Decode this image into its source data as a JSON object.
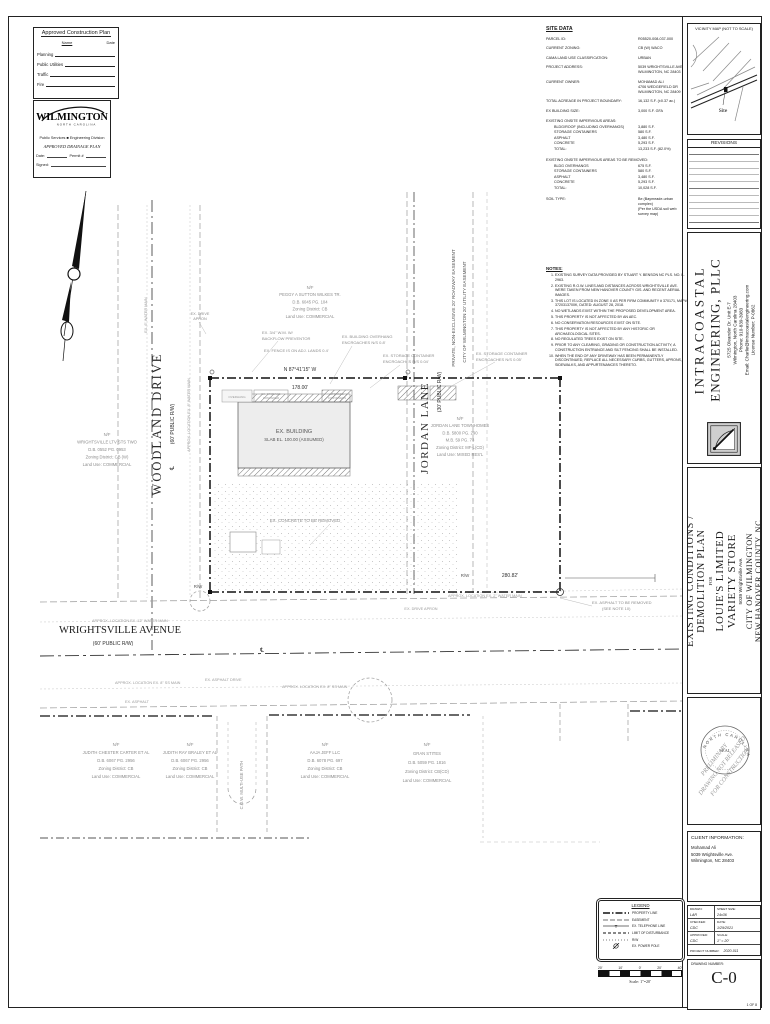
{
  "colors": {
    "ink": "#1a1a1a",
    "muted": "#8a8a8a",
    "paper": "#ffffff"
  },
  "approval_box": {
    "title": "Approved Construction Plan",
    "col_name": "Name",
    "col_date": "Date",
    "rows": [
      "Planning",
      "Public Utilities",
      "Traffic",
      "Fire"
    ]
  },
  "wilmington_box": {
    "city": "WILMINGTON",
    "state": "NORTH CAROLINA",
    "dept": "Public Services  ■  Engineering Division",
    "plan_type": "APPROVED DRAINAGE PLAN",
    "date_label": "Date:",
    "permit_label": "Permit #",
    "signed_label": "Signed:"
  },
  "site_data": {
    "title": "SITE DATA",
    "rows": [
      {
        "l": "PARCEL ID:",
        "v": [
          "R05520-008-037-000"
        ]
      },
      {
        "l": "CURRENT ZONING:",
        "v": [
          "CB (W) WACO"
        ]
      },
      {
        "l": "CAMA LAND USE CLASSIFICATION:",
        "v": [
          "URBAN"
        ]
      },
      {
        "l": "PROJECT ADDRESS:",
        "v": [
          "5039 WRIGHTSVILLE AVE",
          "WILMINGTON, NC 28403"
        ]
      },
      {
        "l": "CURRENT OWNER:",
        "v": [
          "MOHAMAD ALI",
          "4706 WEDGEFIELD DR",
          "WILMINGTON, NC 28409"
        ]
      },
      {
        "l": "TOTAL ACREAGE IN PROJECT BOUNDARY:",
        "v": [
          "16,132 S.F. (±0.37 ac.)"
        ]
      },
      {
        "l": "EX BUILDING SIZE:",
        "v": [
          "3,000 S.F. GFA"
        ]
      }
    ],
    "impervious_title": "EXISTING ONSITE IMPERVIOUS AREAS:",
    "impervious_rows": [
      {
        "l": "BLDG/ROOF (INCLUDING OVERHANGS)",
        "v": "3,880 S.F."
      },
      {
        "l": "STORAGE CONTAINERS",
        "v": "580 S.F."
      },
      {
        "l": "ASPHALT",
        "v": "3,480 S.F."
      },
      {
        "l": "CONCRETE",
        "v": "5,293 S.F."
      },
      {
        "l": "TOTAL:",
        "v": "13,233 S.F. (82.0%)"
      }
    ],
    "removed_title": "EXISTING ONSITE IMPERVIOUS AREAS TO BE REMOVED:",
    "removed_rows": [
      {
        "l": "BLDG OVERHANGS",
        "v": "675 S.F."
      },
      {
        "l": "STORAGE CONTAINERS",
        "v": "580 S.F."
      },
      {
        "l": "ASPHALT",
        "v": "3,480 S.F."
      },
      {
        "l": "CONCRETE",
        "v": "5,293 S.F."
      },
      {
        "l": "TOTAL:",
        "v": "10,028 S.F."
      }
    ],
    "soil_label": "SOIL TYPE:",
    "soil_v1": "Be (Baymeade-urban complex)",
    "soil_v2": "(Per the USDA soil web survey map)"
  },
  "notes": {
    "title": "NOTES:",
    "items": [
      "EXISTING SURVEY DATA PROVIDED BY STUART Y. BENSON NC PLS. NO. L-2963.",
      "EXISTING R.O.W. LINES AND DISTANCES ACROSS WRIGHTSVILLE AVE. WERE TAKEN FROM NEW HANOVER COUNTY GIS. AND RECENT AERIAL IMAGES.",
      "THIS LOT IS LOCATED IN ZONE X AS PER FIRM COMMUNITY # 370171, MAP# 3720313700K, DATED: AUGUST 28, 2018.",
      "NO WETLANDS EXIST WITHIN THE PROPOSED DEVELOPMENT AREA.",
      "THIS PROPERTY IS NOT AFFECTED BY AN AEC.",
      "NO CONSERVATION RESOURCES EXIST ON SITE.",
      "THIS PROPERTY IS NOT AFFECTED BY ANY HISTORIC OR ARCHAEOLOGICAL SITES.",
      "NO REGULATED TREES EXIST ON SITE.",
      "PRIOR TO ANY CLEARING, GRADING OR CONSTRUCTION ACTIVITY, A CONSTRUCTION ENTRANCE AND SILT FENCING SHALL BE INSTALLED.",
      "WHEN THE END OF ANY DRIVEWAY HAS BEEN PERMANENTLY DISCONTINUED, REPLACE ALL NECESSARY CURBS, GUTTERS, APRONS, SIDEWALKS, AND APPURTENANCES THERETO."
    ]
  },
  "vicinity": {
    "title": "VICINITY MAP (NOT TO SCALE)",
    "site_label": "Site"
  },
  "revisions": {
    "title": "REVISIONS"
  },
  "engineer": {
    "name1": "INTRACOASTAL",
    "name2": "ENGINEERING, PLLC",
    "address1": "5725 Oleander Dr. Unit E-7",
    "address2": "Wilmington, North Carolina 28403",
    "phone": "Phone: 910-839-3983",
    "email": "Email: Charlie@intracoastalengineering.com",
    "license": "License Number: P-0862"
  },
  "title_block": {
    "line1": "EXISTING CONDITIONS /",
    "line2": "DEMOLITION PLAN",
    "for_word": "FOR",
    "client1": "LOUIE'S LIMITED",
    "client2": "VARIETY STORE",
    "address": "5039 Wrightsville Ave.",
    "city": "CITY OF WILMINGTON",
    "county": "NEW HANOVER COUNTY, NC"
  },
  "seal": {
    "state": "NORTH CAROLINA",
    "seal_word": "SEAL",
    "overlay1": "PRELIMINARY",
    "overlay2": "DRAWING NOT RELEASED",
    "overlay3": "FOR CONSTRUCTION"
  },
  "client_info": {
    "title": "CLIENT INFORMATION:",
    "name": "Mohamad Ali",
    "address": "5039 Wrightsville Ave.",
    "city": "Wilmington, NC 28403"
  },
  "info_table": {
    "drawn_label": "DRAWN:",
    "drawn": "LAR",
    "sheet_label": "SHEET SIZE:",
    "sheet": "24x36",
    "checked_label": "CHECKED:",
    "checked": "CDC",
    "date_label": "DATE:",
    "date": "1/29/2021",
    "approved_label": "APPROVED:",
    "approved": "CDC",
    "scale_label": "SCALE:",
    "scale": "1\" = 20'",
    "project_label": "PROJECT NUMBER:",
    "project": "2020-011"
  },
  "drawing_number": {
    "label": "DRAWING NUMBER:",
    "value": "C-0",
    "sheet": "1 OF 8"
  },
  "legend": {
    "title": "LEGEND",
    "items": [
      {
        "k": "prop",
        "t": "PROPERTY LINE"
      },
      {
        "k": "dash",
        "t": "EASEMENT"
      },
      {
        "k": "tel",
        "t": "EX. TELEPHONE LINE"
      },
      {
        "k": "lod",
        "t": "LIMIT OF DISTURBANCE"
      },
      {
        "k": "dots",
        "t": "R/W"
      },
      {
        "k": "pole",
        "t": "EX. POWER POLE"
      }
    ],
    "ticks": [
      "20'",
      "10'",
      "0'",
      "20'",
      "40'"
    ],
    "scale_caption": "Scale: 1\"=20'"
  },
  "plan": {
    "labels": [
      {
        "t": "WOODLAND DRIVE",
        "x": 161,
        "y": 424,
        "r": -90,
        "s": 12.5,
        "f": "serif",
        "c": "#2a2a2a",
        "ls": 2
      },
      {
        "t": "(60' PUBLIC R/W)",
        "x": 174,
        "y": 424,
        "r": -90,
        "s": 5,
        "c": "#2a2a2a"
      },
      {
        "t": "℄",
        "x": 174,
        "y": 468,
        "r": -90,
        "s": 6,
        "c": "#2a2a2a"
      },
      {
        "t": "JORDAN LANE",
        "x": 428,
        "y": 428,
        "r": -90,
        "s": 11,
        "f": "serif",
        "c": "#2a2a2a",
        "ls": 1.5
      },
      {
        "t": "(30' PUBLIC R/W)",
        "x": 441,
        "y": 392,
        "r": -90,
        "s": 5,
        "c": "#2a2a2a"
      },
      {
        "t": "PRIVATE, NON-EXCLUSIVE 20' ROADWAY EASEMENT",
        "x": 455,
        "y": 308,
        "r": -90,
        "s": 4.6,
        "c": "#555"
      },
      {
        "t": "CITY OF WILMINGTON 20' UTILITY EASEMENT",
        "x": 466,
        "y": 312,
        "r": -90,
        "s": 4.6,
        "c": "#555"
      },
      {
        "t": "WRIGHTSVILLE AVENUE",
        "x": 120,
        "y": 633,
        "s": 10.5,
        "f": "serif",
        "c": "#1a1a1a"
      },
      {
        "t": "(60' PUBLIC R/W)",
        "x": 113,
        "y": 645,
        "s": 5,
        "c": "#2a2a2a"
      },
      {
        "t": "℄",
        "x": 262,
        "y": 652,
        "s": 6,
        "c": "#2a2a2a"
      },
      {
        "t": "EX. BUILDING",
        "x": 294,
        "y": 433,
        "s": 5.5,
        "c": "#555"
      },
      {
        "t": "SLAB EL. 100.00 (ASSUMED)",
        "x": 294,
        "y": 441,
        "s": 4.4,
        "c": "#555"
      },
      {
        "t": "OVERHANG",
        "x": 237,
        "y": 398,
        "s": 3,
        "c": "#999"
      },
      {
        "t": "EX. STORAGE",
        "x": 271,
        "y": 395,
        "s": 2.8,
        "c": "#999"
      },
      {
        "t": "CONTAINER",
        "x": 271,
        "y": 399,
        "s": 2.8,
        "c": "#999"
      },
      {
        "t": "STORAGE",
        "x": 337,
        "y": 395,
        "s": 2.8,
        "c": "#999"
      },
      {
        "t": "CONTAINERS",
        "x": 337,
        "y": 399,
        "s": 2.8,
        "c": "#999"
      },
      {
        "t": "N 87°41'15\" W",
        "x": 300,
        "y": 371,
        "s": 5,
        "c": "#333"
      },
      {
        "t": "178.00'",
        "x": 300,
        "y": 389,
        "s": 5,
        "c": "#333"
      },
      {
        "t": "280.82'",
        "x": 510,
        "y": 577,
        "s": 5,
        "c": "#333"
      },
      {
        "t": "R/W",
        "x": 465,
        "y": 577,
        "s": 4.4,
        "c": "#555"
      },
      {
        "t": "R/W",
        "x": 198,
        "y": 588,
        "s": 4.4,
        "c": "#555"
      },
      {
        "t": "EX. 3/4\" W.M. W/",
        "x": 262,
        "y": 334,
        "s": 4,
        "c": "#8c8c8c",
        "a": "start"
      },
      {
        "t": "BACKFLOW PREVENTOR",
        "x": 262,
        "y": 340,
        "s": 4,
        "c": "#8c8c8c",
        "a": "start"
      },
      {
        "t": "EX. FENCE IS ON ADJ. LANDS 0.4'",
        "x": 264,
        "y": 352,
        "s": 4,
        "c": "#8c8c8c",
        "a": "start"
      },
      {
        "t": "EX. BUILDING OVERHANG",
        "x": 342,
        "y": 338,
        "s": 4,
        "c": "#8c8c8c",
        "a": "start"
      },
      {
        "t": "ENCROACHES N/S 0.8'",
        "x": 342,
        "y": 344,
        "s": 4,
        "c": "#8c8c8c",
        "a": "start"
      },
      {
        "t": "EX. STORAGE CONTAINER",
        "x": 383,
        "y": 357,
        "s": 4,
        "c": "#8c8c8c",
        "a": "start"
      },
      {
        "t": "ENCROACHES N/S 0.04'",
        "x": 383,
        "y": 363,
        "s": 4,
        "c": "#8c8c8c",
        "a": "start"
      },
      {
        "t": "EX. STORAGE CONTAINER",
        "x": 476,
        "y": 355,
        "s": 4,
        "c": "#8c8c8c",
        "a": "start"
      },
      {
        "t": "ENCROACHES N/S 0.05'",
        "x": 476,
        "y": 361,
        "s": 4,
        "c": "#8c8c8c",
        "a": "start"
      },
      {
        "t": "EX. DRIVE",
        "x": 200,
        "y": 315,
        "s": 3.8,
        "c": "#8c8c8c"
      },
      {
        "t": "APRON",
        "x": 200,
        "y": 320,
        "s": 3.8,
        "c": "#8c8c8c"
      },
      {
        "t": "EX. CONCRETE TO BE REMOVED",
        "x": 305,
        "y": 522,
        "s": 4.4,
        "c": "#8c8c8c"
      },
      {
        "t": "EX. ASPHALT TO BE REMOVED",
        "x": 592,
        "y": 604,
        "s": 4,
        "c": "#8c8c8c",
        "a": "start"
      },
      {
        "t": "(SEE NOTE 10)",
        "x": 602,
        "y": 610,
        "s": 4,
        "c": "#8c8c8c",
        "a": "start"
      },
      {
        "t": "APPROX. LOCATION EX. 12\" WATER MAIN",
        "x": 92,
        "y": 622,
        "s": 3.8,
        "c": "#9a9a9a",
        "a": "start"
      },
      {
        "t": "APPROX. LOCATION EX. 8\" SS MAIN",
        "x": 115,
        "y": 684,
        "s": 3.8,
        "c": "#9a9a9a",
        "a": "start"
      },
      {
        "t": "EX. ASPHALT",
        "x": 125,
        "y": 703,
        "s": 3.8,
        "c": "#9a9a9a",
        "a": "start"
      },
      {
        "t": "EX. ASPHALT DRIVE",
        "x": 205,
        "y": 681,
        "s": 3.8,
        "c": "#9a9a9a",
        "a": "start"
      },
      {
        "t": "APPROX. LOCATION EX. 8\" SS MAIN",
        "x": 282,
        "y": 688,
        "s": 3.8,
        "c": "#9a9a9a",
        "a": "start"
      },
      {
        "t": "APPROX. LOCATION EX. 2\" WATER MAIN",
        "x": 448,
        "y": 597,
        "s": 3.8,
        "c": "#9a9a9a",
        "a": "start"
      },
      {
        "t": "EX. DRIVE APRON",
        "x": 421,
        "y": 610,
        "s": 3.8,
        "c": "#9a9a9a"
      },
      {
        "t": "C.O.W. MULTI-USE PATH",
        "x": 243,
        "y": 785,
        "r": -90,
        "s": 4.2,
        "c": "#8c8c8c"
      },
      {
        "t": "APPROX. LOCATION EX. 8\" WATER MAIN",
        "x": 190,
        "y": 415,
        "r": -90,
        "s": 3.8,
        "c": "#9a9a9a"
      },
      {
        "t": "EX. 6\" WATER MAIN",
        "x": 147,
        "y": 315,
        "r": -90,
        "s": 3.8,
        "c": "#9a9a9a"
      }
    ],
    "parcels": [
      {
        "cx": 310,
        "y": 289,
        "dy": 7.2,
        "lines": [
          "N/F",
          "PEGGY A SUTTON WILKES TR.",
          "D.B. 6045 PG. 104",
          "Zoning District: CB",
          "Land Use: COMMERCIAL"
        ]
      },
      {
        "cx": 107,
        "y": 436,
        "dy": 7.5,
        "lines": [
          "N/F",
          "WRIGHTSVILLE LTV STS TWO",
          "D.B. 0552 PG. 0953",
          "Zoning District: CB (W)",
          "Land Use: COMMERCIAL"
        ]
      },
      {
        "cx": 460,
        "y": 420,
        "dy": 7.2,
        "lines": [
          "N/F",
          "JORDAN LANE TOWNHOMES",
          "D.B. 5800 PG. 290",
          "M.B. 59 PG. 73",
          "Zoning District: MF-L(CD)",
          "Land Use: MIXED RES'L"
        ]
      },
      {
        "cx": 116,
        "y": 746,
        "dy": 8,
        "lines": [
          "N/F",
          "JUDITH CHESTER CARTER ET AL",
          "D.B. 6067 PG. 2956",
          "Zoning District: CB",
          "Land Use: COMMERCIAL"
        ]
      },
      {
        "cx": 190,
        "y": 746,
        "dy": 8,
        "lines": [
          "N/F",
          "JUDITH RAY BRALEY ET AL",
          "D.B. 6067 PG. 2956",
          "Zoning District: CB",
          "Land Use: COMMERCIAL"
        ]
      },
      {
        "cx": 325,
        "y": 746,
        "dy": 8,
        "lines": [
          "N/F",
          "AAJA JEFF LLC",
          "D.B. 6078 PG. 697",
          "Zoning District: CB",
          "Land Use: COMMERCIAL"
        ]
      },
      {
        "cx": 427,
        "y": 746,
        "dy": 9,
        "lines": [
          "N/F",
          "GRAN STITES",
          "D.B. 5059 PG. 1816",
          "Zoning District: CB(CD)",
          "Land Use: COMMERCIAL"
        ]
      }
    ]
  }
}
